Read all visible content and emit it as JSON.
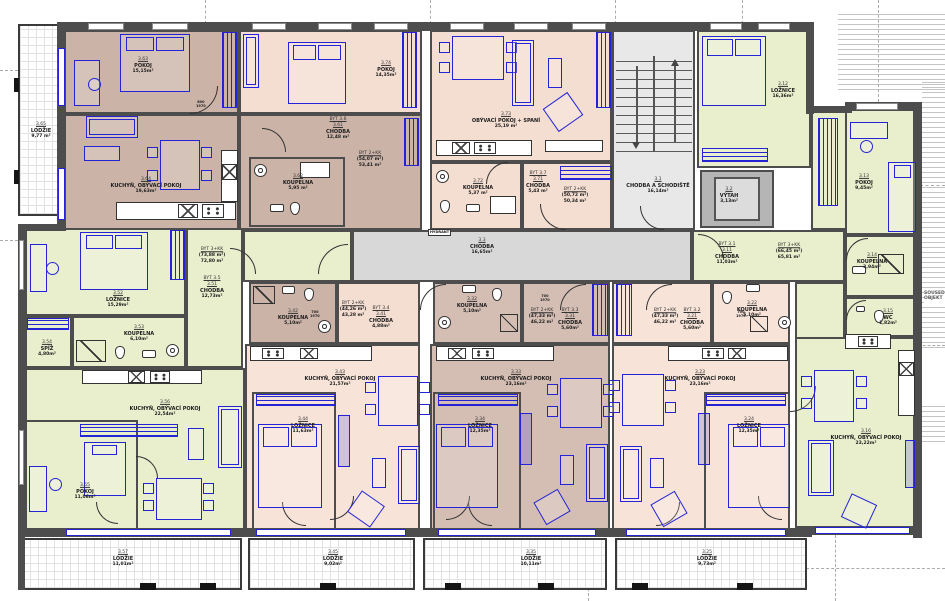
{
  "plan": {
    "neighbor_line1": "SOUSEDNÍ",
    "neighbor_line2": "OBJEKT",
    "hydrant": "HYDRANT"
  },
  "door_tags": {
    "entry_w": "800",
    "bath_w": "700",
    "h": "1970"
  },
  "common": {
    "c31": {
      "num": "3.1",
      "name": "CHODBA A SCHODIŠTĚ",
      "area": "16,14m²"
    },
    "c32": {
      "num": "3.2",
      "name": "VÝTAH",
      "area": "3,13m²"
    },
    "c33": {
      "num": "3.3",
      "name": "CHODBA",
      "area": "16,65m²"
    }
  },
  "apartments": {
    "byt31": {
      "tag": "BYT 3.1",
      "type": "BYT 3+KK",
      "gross": "(66,45 m²)",
      "net": "65,81 m²"
    },
    "byt32": {
      "tag": "BYT 3.2",
      "type": "BYT 2+KK",
      "gross": "(47,33 m²)",
      "net": "46,22 m²"
    },
    "byt33": {
      "tag": "BYT 3.3",
      "type": "BYT 2+KK",
      "gross": "(47,33 m²)",
      "net": "46,22 m²"
    },
    "byt34": {
      "tag": "BYT 3.4",
      "type": "BYT 2+KK",
      "gross": "(44,26 m²)",
      "net": "43,28 m²"
    },
    "byt35": {
      "tag": "BYT 3.5",
      "type": "BYT 3+KK",
      "gross": "(73,88 m²)",
      "net": "72,80 m²"
    },
    "byt36": {
      "tag": "BYT 3.6",
      "type": "BYT 2+KK",
      "gross": "(54,07 m²)",
      "net": "53,41 m²"
    },
    "byt37": {
      "tag": "BYT 3.7",
      "type": "BYT 2+KK",
      "gross": "(50,72 m²)",
      "net": "50,34 m²"
    }
  },
  "rooms": {
    "r311": {
      "num": "3.11",
      "name": "CHODBA",
      "area": "11,03m²"
    },
    "r312": {
      "num": "3.12",
      "name": "LOŽNICE",
      "area": "16,36m²"
    },
    "r313": {
      "num": "3.13",
      "name": "POKOJ",
      "area": "9,45m²"
    },
    "r314": {
      "num": "3.14",
      "name": "KOUPELNA",
      "area": "3,94m²"
    },
    "r315": {
      "num": "3.15",
      "name": "WC",
      "area": "1,82m²"
    },
    "r316": {
      "num": "3.16",
      "name": "KUCHYŇ, OBÝVACÍ POKOJ",
      "area": "23,22m²"
    },
    "r321": {
      "num": "3.21",
      "name": "CHODBA",
      "area": "5,60m²"
    },
    "r322": {
      "num": "3.22",
      "name": "KOUPELNA",
      "area": "5,10m²"
    },
    "r323": {
      "num": "3.23",
      "name": "KUCHYŇ, OBÝVACÍ POKOJ",
      "area": "23,16m²"
    },
    "r324": {
      "num": "3.24",
      "name": "LOŽNICE",
      "area": "12,35m²"
    },
    "r325": {
      "num": "3.25",
      "name": "LODŽIE",
      "area": "9,73m²"
    },
    "r331": {
      "num": "3.31",
      "name": "CHODBA",
      "area": "5,60m²"
    },
    "r332": {
      "num": "3.32",
      "name": "KOUPELNA",
      "area": "5,10m²"
    },
    "r333": {
      "num": "3.33",
      "name": "KUCHYŇ, OBÝVACÍ POKOJ",
      "area": "23,16m²"
    },
    "r334": {
      "num": "3.34",
      "name": "LOŽNICE",
      "area": "12,35m²"
    },
    "r335": {
      "num": "3.35",
      "name": "LODŽIE",
      "area": "10,11m²"
    },
    "r341": {
      "num": "3.41",
      "name": "CHODBA",
      "area": "4,88m²"
    },
    "r342": {
      "num": "3.42",
      "name": "KOUPELNA",
      "area": "5,10m²"
    },
    "r343": {
      "num": "3.43",
      "name": "KUCHYŇ, OBÝVACÍ POKOJ",
      "area": "21,57m²"
    },
    "r344": {
      "num": "3.44",
      "name": "LOŽNICE",
      "area": "11,63m²"
    },
    "r345": {
      "num": "3.45",
      "name": "LODŽIE",
      "area": "9,02m²"
    },
    "r351": {
      "num": "3.51",
      "name": "CHODBA",
      "area": "12,73m²"
    },
    "r352": {
      "num": "3.52",
      "name": "LOŽNICE",
      "area": "15,29m²"
    },
    "r353": {
      "num": "3.53",
      "name": "KOUPELNA",
      "area": "6,10m²"
    },
    "r354": {
      "num": "3.54",
      "name": "SPÍŽ",
      "area": "4,80m²"
    },
    "r355": {
      "num": "3.55",
      "name": "POKOJ",
      "area": "11,06m²"
    },
    "r356": {
      "num": "3.56",
      "name": "KUCHYŇ, OBÝVACÍ POKOJ",
      "area": "22,54m²"
    },
    "r357": {
      "num": "3.57",
      "name": "LODŽIE",
      "area": "11,01m²"
    },
    "r361": {
      "num": "3.61",
      "name": "CHODBA",
      "area": "12,48 m²"
    },
    "r362": {
      "num": "3.62",
      "name": "KOUPELNA",
      "area": "5,95 m²"
    },
    "r363": {
      "num": "3.63",
      "name": "POKOJ",
      "area": "15,15m²"
    },
    "r364": {
      "num": "3.64",
      "name": "KUCHYŇ, OBÝVACÍ POKOJ",
      "area": "19,63m²"
    },
    "r365": {
      "num": "3.65",
      "name": "LODŽIE",
      "area": "9,77 m²"
    },
    "r371": {
      "num": "3.71",
      "name": "CHODBA",
      "area": "5,43 m²"
    },
    "r372": {
      "num": "3.72",
      "name": "KOUPELNA",
      "area": "5,37 m²"
    },
    "r373": {
      "num": "3.73",
      "name": "OBÝVACÍ POKOJ + SPANÍ",
      "area": "25,19 m²"
    },
    "r374": {
      "num": "3.74",
      "name": "POKOJ",
      "area": "14,35m²"
    }
  },
  "colors": {
    "wall": "#4d4d4d",
    "furniture_blue": "#2424d6",
    "apartment_mauve": "#cbb3a8",
    "apartment_mauve2": "#d4bdb3",
    "apartment_peach": "#f4ddd1",
    "apartment_peach_light": "#f7e3d8",
    "apartment_green": "#e9eecd",
    "corridor_gray": "#d8d8d8",
    "stair_gray": "#e8e8e8",
    "elevator_gray": "#b5b5b5"
  }
}
